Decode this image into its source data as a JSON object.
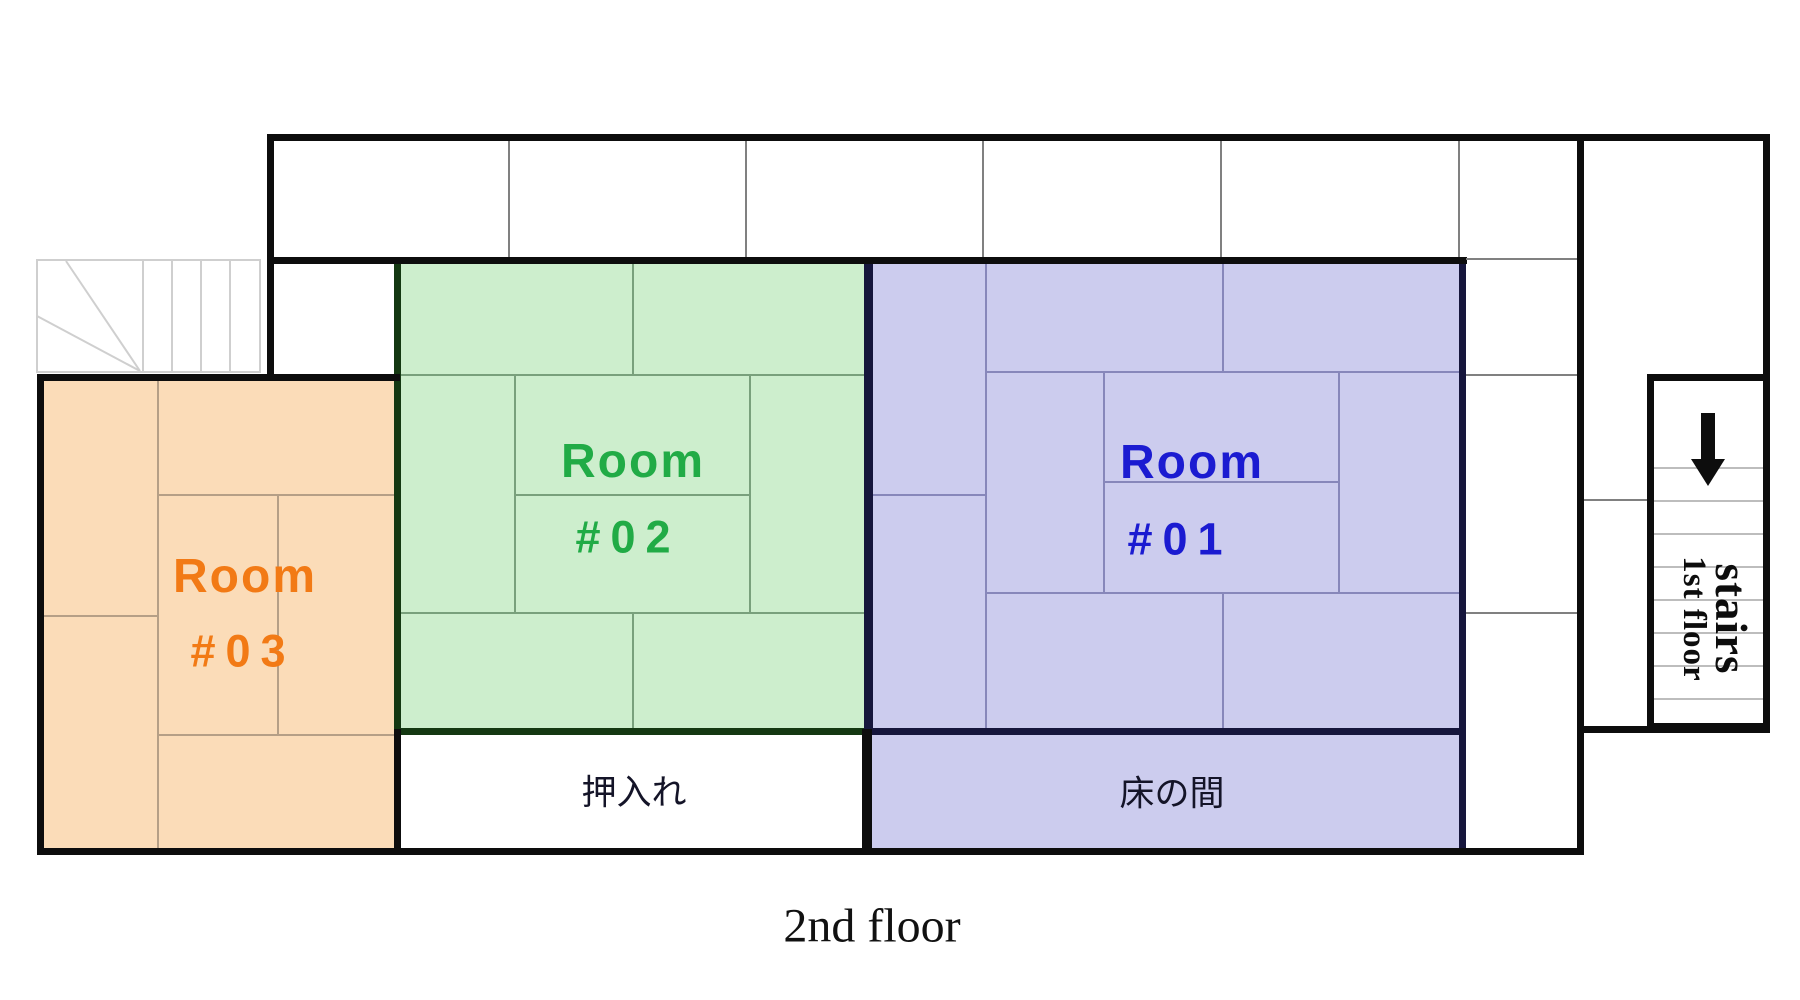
{
  "title": "2nd floor",
  "rooms": {
    "room01": {
      "name": "Room #01",
      "line1": "Room",
      "line2": "#01",
      "label_color": "#1b1bd1",
      "fill": "#ccccee"
    },
    "room02": {
      "name": "Room #02",
      "line1": "Room",
      "line2": "#02",
      "label_color": "#21ab46",
      "fill": "#cdeecd"
    },
    "room03": {
      "name": "Room #03",
      "line1": "Room",
      "line2": "#03",
      "label_color": "#f27a15",
      "fill": "#fbdcb8"
    }
  },
  "areas": {
    "closet": "押入れ",
    "alcove": "床の間"
  },
  "stairs_note": {
    "line1": "stairs",
    "line2": "1st floor",
    "icon": "down-arrow"
  },
  "palette": {
    "wall": "#0d0d0d",
    "room01_border": "#16163c",
    "room02_border": "#143812",
    "stair_line": "#cfcfcf",
    "tatami_line_blue": "#8787ba",
    "tatami_line_green": "#79a07c",
    "tatami_line_orange": "#b59f86"
  }
}
